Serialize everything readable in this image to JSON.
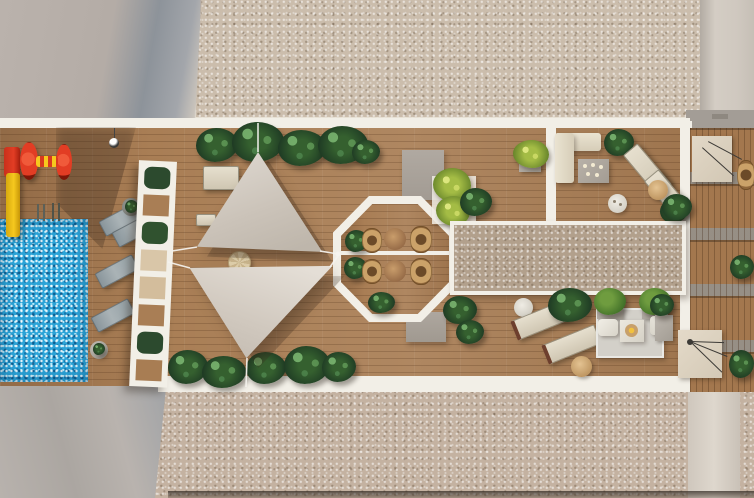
{
  "meta": {
    "title": "Top-down 3D render of a rooftop terrace with swimming pool, shade sails and lounge areas",
    "type": "architectural visualization, aerial plan view",
    "text_content": "none (image contains no readable text)"
  },
  "palette": {
    "white-s": "#f2efe7",
    "wood": "#a97e55",
    "wood-dark": "#7d5835",
    "gravel-top": "#cbbdac",
    "gravel-mid": "#b2a08c",
    "gravel-bottom": "#c4b2a1",
    "roof-gray": "#b4aca6",
    "roof-gray-dark": "#8e949b",
    "pool-blue": "#2ba3d7",
    "sail": "#d0c9bf",
    "plant-dark": "#1d3823",
    "plant-mid": "#35602f",
    "plant-yellow": "#a4bc45",
    "slide-red": "#e23d24",
    "slide-yellow": "#f6c81e",
    "cream": "#e4ddcb",
    "lounger-gray": "#97a2a7",
    "tan": "#d3ad79",
    "slab-gray": "#a69f97",
    "rug": "#d3d0c9"
  },
  "scene": {
    "objects": {
      "terrace": "Main rooftop terrace",
      "deck": "Timber deck",
      "pool": "Swimming pool",
      "poolLadder": "Pool ladder",
      "playSlide": "Children's slide",
      "playRoller": "Play structure",
      "pendantLight": "Hanging lamp",
      "sunLoungerGray": "Sun lounger",
      "sunLoungerCream": "Sun lounger",
      "sideTable": "Side table",
      "trellis": "White slatted pergola screen",
      "plant": "Planting",
      "sailUpper": "Shade sail",
      "sailLower": "Shade sail",
      "ropes": "Sail tension ropes",
      "parasol": "Parasol table",
      "octagon": "Octagonal seating pavilion",
      "bistroTable": "Round bistro table",
      "bistroChair": "Wicker chair",
      "slab": "Concrete landing",
      "gravelRoofTop": "Gravel roof area",
      "gravelPanel": "Gravel roof panel",
      "gravelRoofBottom": "Gravel roof area",
      "sofa": "Outdoor corner sofa",
      "coffeeTable": "Coffee table with candles",
      "dayBed": "Day bed",
      "teaTable": "Tea table",
      "rug": "Outdoor rug",
      "armchair": "Armchair",
      "fireTable": "Fire table",
      "planter": "Planter box",
      "neighborTerrace": "Neighbouring rooftop terrace",
      "stairHatch": "Roof access hatch",
      "wickerChair": "Wicker chair",
      "adjacentRoofLeft": "Adjacent flat roof",
      "adjacentRoofBottom": "Adjacent flat roof",
      "pathway": "Walkway",
      "vent": "Roof vent"
    }
  }
}
